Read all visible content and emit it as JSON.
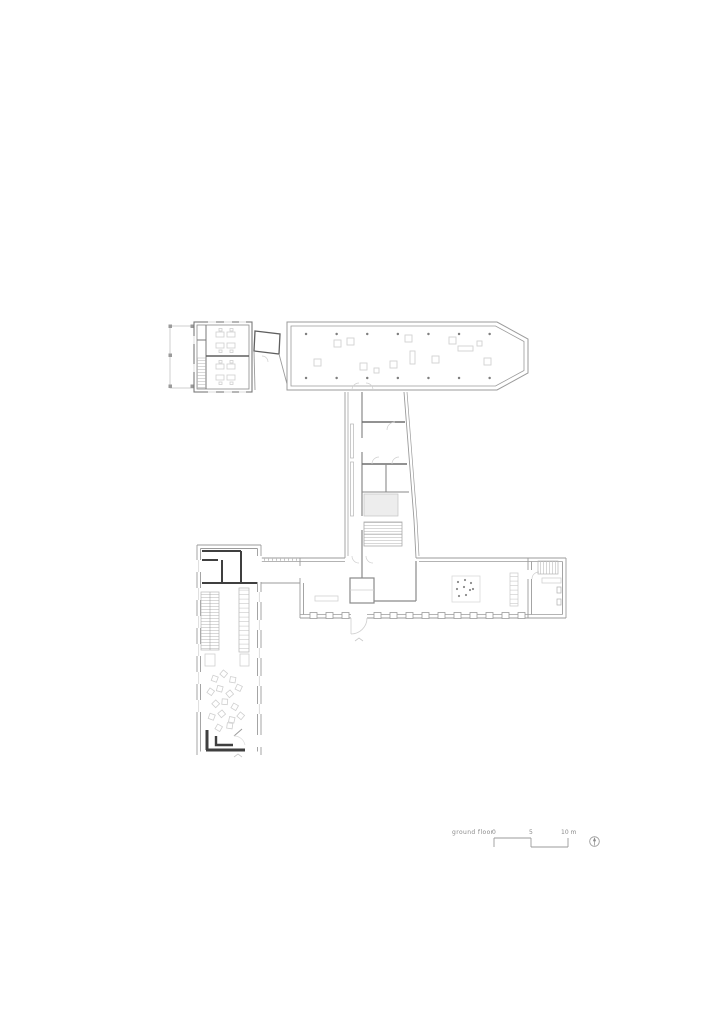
{
  "sheet": {
    "background": "#ffffff",
    "type_label": "architectural floor plan"
  },
  "colors": {
    "wall": "#9b9b9b",
    "wall_dark": "#3f3f3f",
    "wall_mid": "#6f6f6f",
    "furniture": "#d2d2d2",
    "column_dot": "#7f7f7f",
    "text": "#8a8a8a"
  },
  "legend": {
    "floor_label": "ground floor",
    "scale": {
      "tick_0": "0",
      "tick_5": "5",
      "tick_10": "10 m"
    },
    "north_icon": "north-arrow-icon"
  }
}
